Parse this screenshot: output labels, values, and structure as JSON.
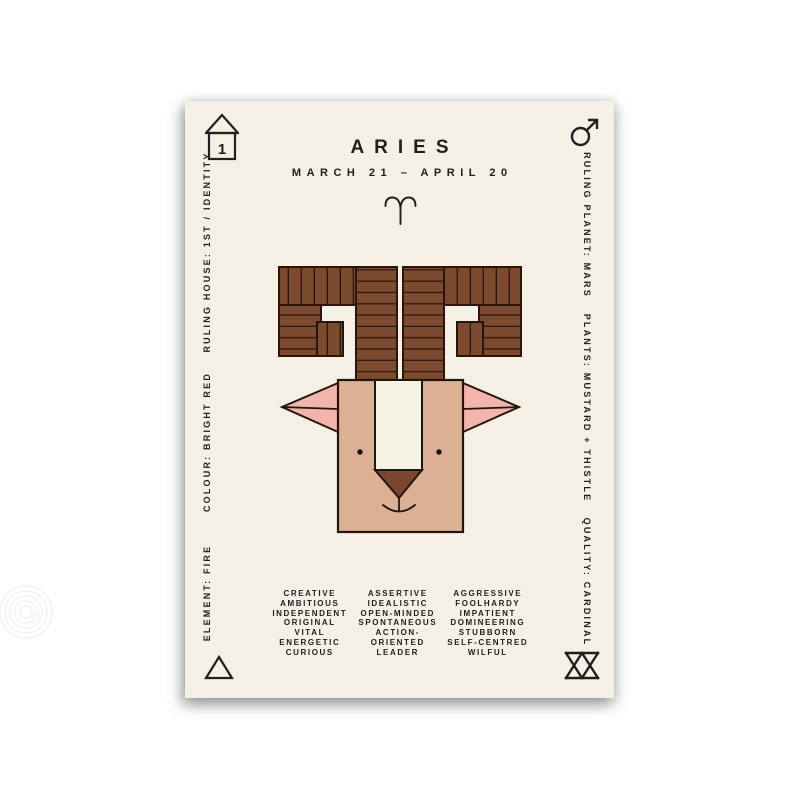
{
  "poster": {
    "title": "ARIES",
    "date_range": "MARCH 21 – APRIL 20",
    "zodiac_symbol": "♈",
    "house_number": "1",
    "side_labels": {
      "left": [
        "RULING HOUSE: 1ST / IDENTITY",
        "COLOUR: BRIGHT RED",
        "ELEMENT: FIRE"
      ],
      "right": [
        "RULING PLANET: MARS",
        "PLANTS: MUSTARD + THISTLE",
        "QUALITY: CARDINAL"
      ]
    },
    "traits_columns": [
      {
        "lines": [
          "CREATIVE",
          "AMBITIOUS",
          "INDEPENDENT",
          "ORIGINAL",
          "VITAL",
          "ENERGETIC",
          "CURIOUS"
        ]
      },
      {
        "lines": [
          "ASSERTIVE",
          "IDEALISTIC",
          "OPEN-MINDED",
          "SPONTANEOUS",
          "ACTION-",
          "ORIENTED",
          "LEADER"
        ]
      },
      {
        "lines": [
          "AGGRESSIVE",
          "FOOLHARDY",
          "IMPATIENT",
          "DOMINEERING",
          "STUBBORN",
          "SELF-CENTRED",
          "WILFUL"
        ]
      }
    ],
    "corner_icons": [
      "house-number-icon",
      "mars-icon",
      "fire-triangle-icon",
      "cardinal-quality-icon"
    ],
    "colors": {
      "page_background": "#ffffff",
      "poster_background": "#f4f0e6",
      "text": "#1f1f1f",
      "horn_brown": "#7b4a2f",
      "outline_dark": "#2a150b",
      "face_tan": "#dbb094",
      "ear_pink": "#f3b5ab",
      "blaze_cream": "#f5f2e6",
      "nose_brown": "#7a4631"
    }
  }
}
